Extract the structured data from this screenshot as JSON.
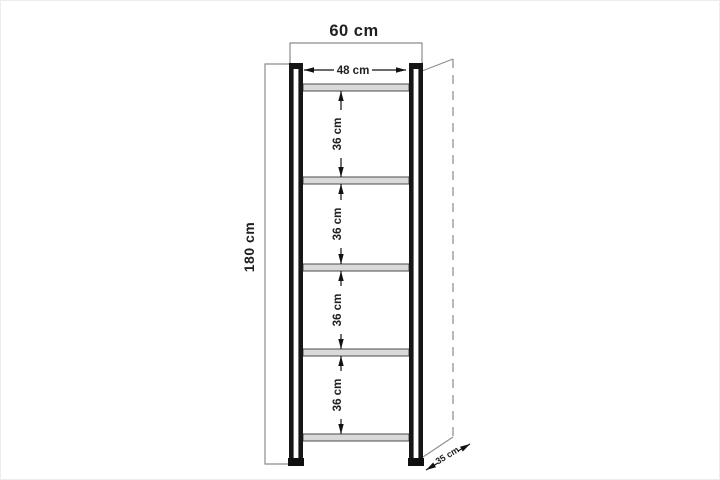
{
  "diagram": {
    "subject": "shelving-unit-front-elevation-drawing",
    "shelf_count": 5,
    "upright_count": 2
  },
  "dimensions": {
    "overall_width": "60 cm",
    "inner_width": "48 cm",
    "overall_height": "180 cm",
    "depth": "35 cm",
    "shelf_gaps": [
      "36 cm",
      "36 cm",
      "36 cm",
      "36 cm"
    ]
  },
  "colors": {
    "frame": "#161616",
    "shelf_fill": "#d9d9d9",
    "shelf_edge": "#4a4a4a",
    "dimension_bracket": "#8c8c8c",
    "dimension_arrow": "#111111",
    "hidden_edge": "#8a8a8a",
    "text": "#1f1f1f",
    "background": "#ffffff"
  }
}
